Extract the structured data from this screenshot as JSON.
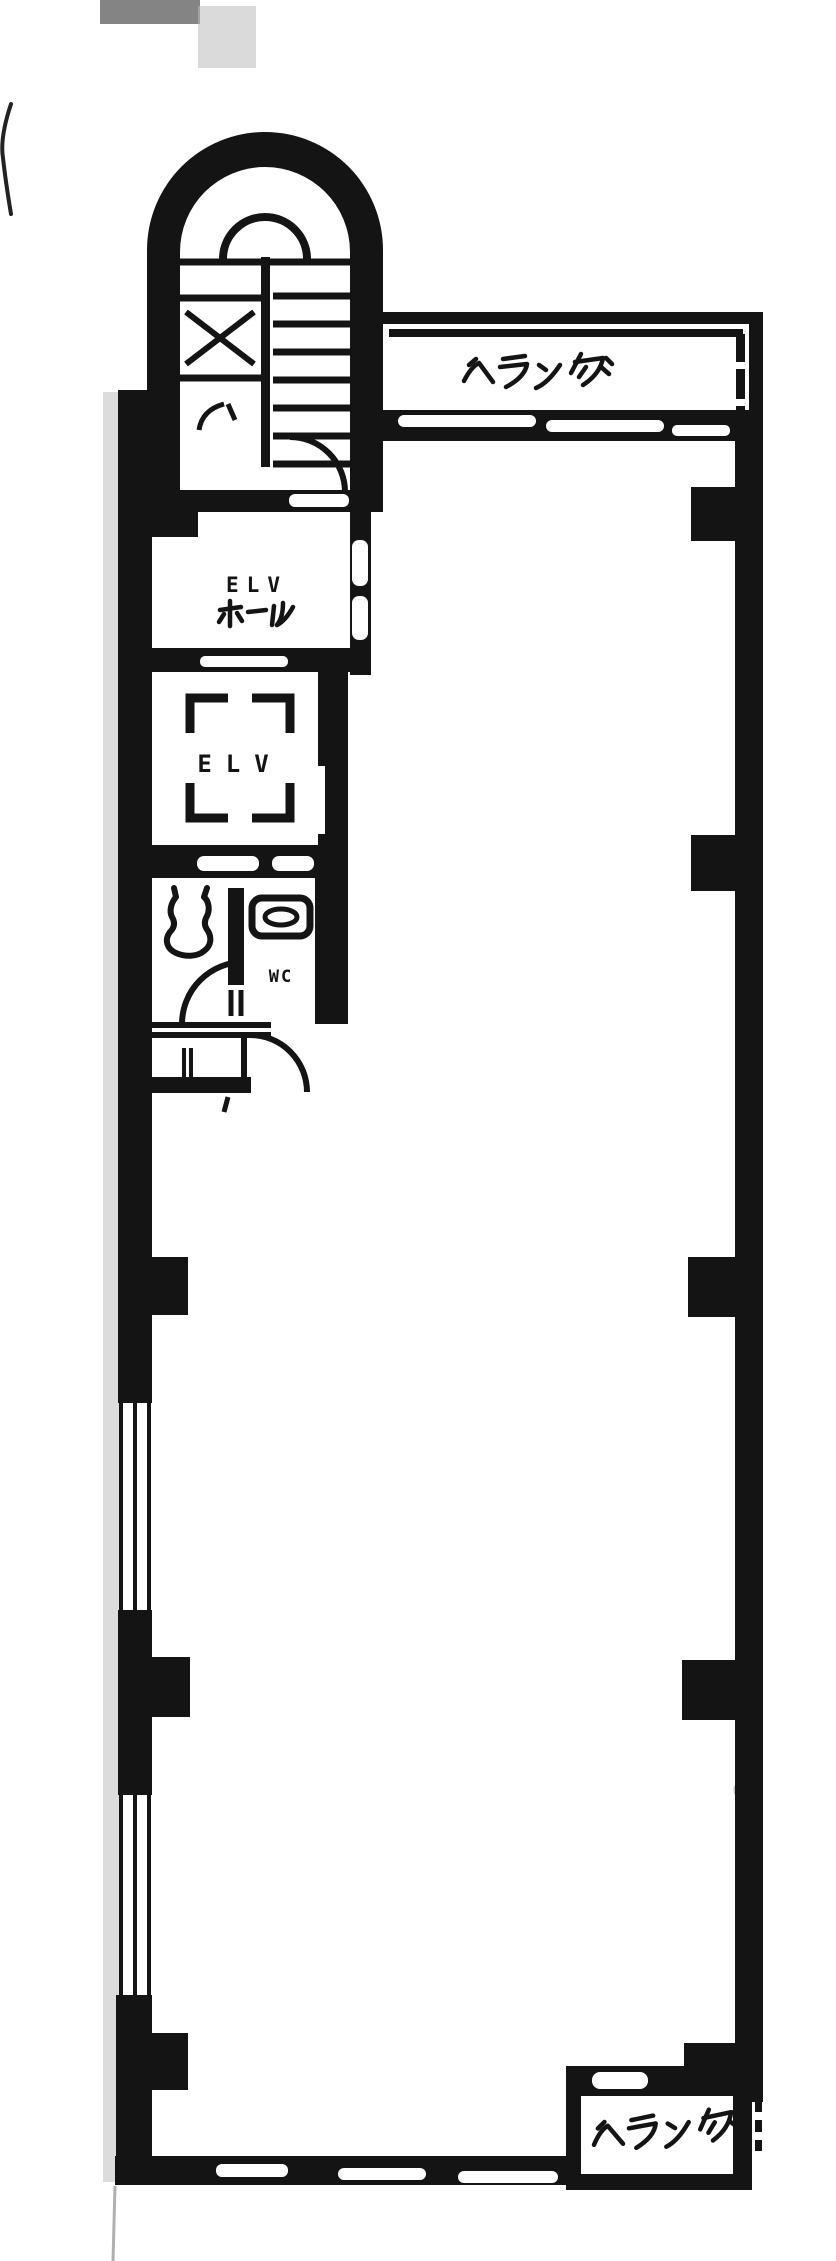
{
  "page": {
    "type": "scanned-floor-plan",
    "language": "ja",
    "colors": {
      "ink": "#141414",
      "paper": "#ffffff",
      "shade": "#c9c9c9"
    }
  },
  "floor_plan": {
    "labels": {
      "balcony_top": "ベランダ",
      "elevator_hall_line1": "ELV",
      "elevator_hall_line2": "ホール",
      "elevator": "ELV",
      "wc": "WC",
      "balcony_bottom": "ベランダ"
    }
  }
}
